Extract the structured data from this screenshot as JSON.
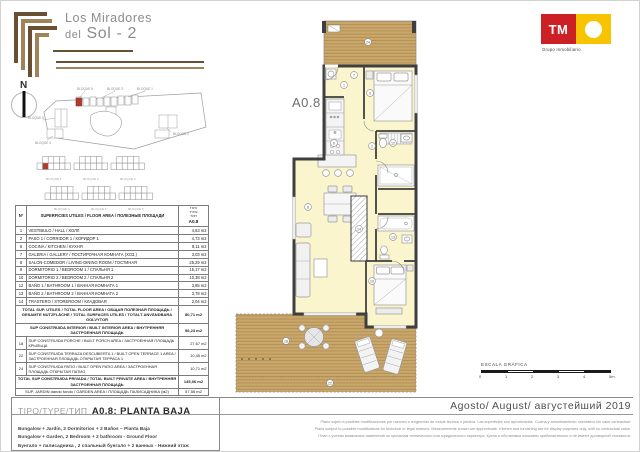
{
  "header": {
    "logo_line1": "Los Miradores",
    "logo_line2_small": "del",
    "logo_line2_big": "Sol - 2",
    "brand_tm": "TM",
    "brand_sub": "Grupo Inmobiliario"
  },
  "north_label": "N",
  "site_plan": {
    "block_labels": [
      "BLOQUE 5",
      "BLOQUE 3",
      "BLOQUE 1",
      "BLOQUE 6",
      "BLOQUE 4",
      "BLOQUE 2"
    ]
  },
  "block_diagrams": [
    {
      "label": "BLOQUE 1",
      "highlight": true
    },
    {
      "label": "BLOQUE 2",
      "highlight": false
    },
    {
      "label": "BLOQUE 3",
      "highlight": false
    },
    {
      "label": "BLOQUE 4",
      "highlight": false
    },
    {
      "label": "BLOQUE 5",
      "highlight": false
    },
    {
      "label": "BLOQUE 6",
      "highlight": false
    }
  ],
  "plan": {
    "unit_label": "A0.8",
    "room_numbers": [
      "1",
      "2",
      "6",
      "7",
      "8",
      "9",
      "10",
      "12",
      "13",
      "14",
      "18",
      "22",
      "24"
    ]
  },
  "table": {
    "header_num": "Nº",
    "header_desc": "SUPERFICIES UTILES / FLOOR AREA / ПОЛЕЗНЫЕ ПЛОЩАДИ",
    "header_type": "TIPO\nTYPE\nТИП",
    "header_unit": "A0.8",
    "rows": [
      {
        "n": "1",
        "desc": "VESTIBULO / HALL / ХОЛЛ",
        "area": "4,63 m2",
        "style": "normal"
      },
      {
        "n": "2",
        "desc": "PASO 1 / CORRIDOR 1 / КОРИДОР 1",
        "area": "4,73 m2",
        "style": "normal"
      },
      {
        "n": "6",
        "desc": "COCINA / KITCHEN / КУХНЯ",
        "area": "8,11 m2",
        "style": "normal"
      },
      {
        "n": "7",
        "desc": "GALERIA / GALLERY / ПОСТИРОЧНАЯ КОМНАТА (ХОЗ.)",
        "area": "3,03 m2",
        "style": "normal"
      },
      {
        "n": "8",
        "desc": "SALON-COMEDOR / LIVING-DINING ROOM / ГОСТИНАЯ",
        "area": "25,29 m2",
        "style": "normal"
      },
      {
        "n": "9",
        "desc": "DORMITORIO 1 / BEDROOM 1 / СПАЛЬНЯ 1",
        "area": "15,17 m2",
        "style": "normal"
      },
      {
        "n": "10",
        "desc": "DORMITORIO 2 / BEDROOM 2 / СПАЛЬНЯ 2",
        "area": "10,38 m2",
        "style": "normal"
      },
      {
        "n": "12",
        "desc": "BAÑO 1 / BATHROOM 1 / ВАННАЯ КОМНАТА 1",
        "area": "3,85 m2",
        "style": "normal"
      },
      {
        "n": "13",
        "desc": "BAÑO 2 / BATHROOM 2 / ВАННАЯ КОМНАТА 2",
        "area": "3,78 m2",
        "style": "normal"
      },
      {
        "n": "14",
        "desc": "TRASTERO / STOREROOM / КЛАДОВАЯ",
        "area": "2,04 m2",
        "style": "normal"
      },
      {
        "n": "",
        "desc": "TOTAL SUP. UTILES / TOTAL FLOOR AREA / ОБЩАЯ ПОЛЕЗНАЯ ПЛОЩАДЬ / GESAMTE NUTZFLÄCHE / TOTAL SURFACES UTILES / TOTALT ANVÄNDBARA GOLVYTOR",
        "area": "80,71 m2",
        "style": "total"
      },
      {
        "n": "",
        "desc": "SUP CONSTRUIDA INTERIOR / BUILT INTERIOR AREA / ВНУТРЕННЯЯ ЗАСТРОЕННАЯ ПЛОЩАДЬ",
        "area": "96,23 m2",
        "style": "total"
      },
      {
        "n": "18",
        "desc": "SUP CONSTRUIDA PORCHE / BUILT PORCH AREA / ЗАСТРОЕННАЯ ПЛОЩАДЬ КРЫЛЬЦА",
        "area": "27,67 m2",
        "style": "sub"
      },
      {
        "n": "22",
        "desc": "SUP CONSTRUIDA TERRAZA DESCUBIERTA 1 / BUILT OPEN TERRACE 1 AREA / ЗАСТРОЕННАЯ ПЛОЩАДЬ ОТКРЫТАЯ ТЕРРАСА 1",
        "area": "10,45 m2",
        "style": "sub"
      },
      {
        "n": "24",
        "desc": "SUP CONSTRUIDA PATIO / BUILT OPEN PATIO AREA / ЗАСТРОЕННАЯ ПЛОЩАДЬ ОТКРЫТАЯ ПАТИО",
        "area": "10,71 m2",
        "style": "sub"
      },
      {
        "n": "",
        "desc": "TOTAL SUP CONSTRUIDA PRIVADA / TOTAL BUILT PRIVATE AREA / ВНУТРЕННЯЯ ЗАСТРОЕННАЯ ПЛОЩАДЬ",
        "area": "145,06 m2",
        "style": "total"
      },
      {
        "n": "",
        "desc": "SUP. JARDIN dando fondo / GARDEN AREA / ПЛОЩАДЬ ПАЛИСАДНИКА (м2)",
        "area": "57,56 m2",
        "style": "garden"
      }
    ]
  },
  "type_box": {
    "prefix": "TIPO/TYPE/ТИП",
    "title": "A0.8: PLANTA BAJA",
    "lines": [
      "Bungalow + Jardín, 2 Dormitorios + 2 Baños – Planta Baja",
      "Bungalow + Garden, 2 Bedroom + 2 bathroom - Ground Floor",
      "Бунгало + палисадника , 2 спальный бунгало + 2 ванных - Нижний этаж"
    ]
  },
  "scale_bar": {
    "label": "ESCALA GRÁFICA",
    "ticks": [
      "0",
      "1",
      "2",
      "3",
      "4",
      "5m"
    ]
  },
  "date_line": "Agosto/ August/ августейший 2019",
  "disclaimer": [
    "Plano sujeto a posibles modificaciones por razones o exigencias de índole técnica o jurídica. Las superficies son aproximadas. Cocina y amueblamiento orientativo sin valor contractual.",
    "Plans subject to possible modifications for technical or legal reasons. Measurements shown are approximate. Kitchen and furnishing are for display purposes only, with no contractual value.",
    "План с учетом возможных изменений по причинам технического или юридического характера. Кухня и обстановка показаны приблизительно и не имеют договорной стоимости."
  ],
  "colors": {
    "accent_red": "#b03a2e",
    "brand_red": "#cc2027",
    "brand_yellow": "#f6c500",
    "wood": "#c9a76a",
    "floor": "#fbf5cd",
    "wall": "#3f3f3f",
    "logo_brown_dark": "#6a5032",
    "logo_brown_light": "#a08358"
  }
}
